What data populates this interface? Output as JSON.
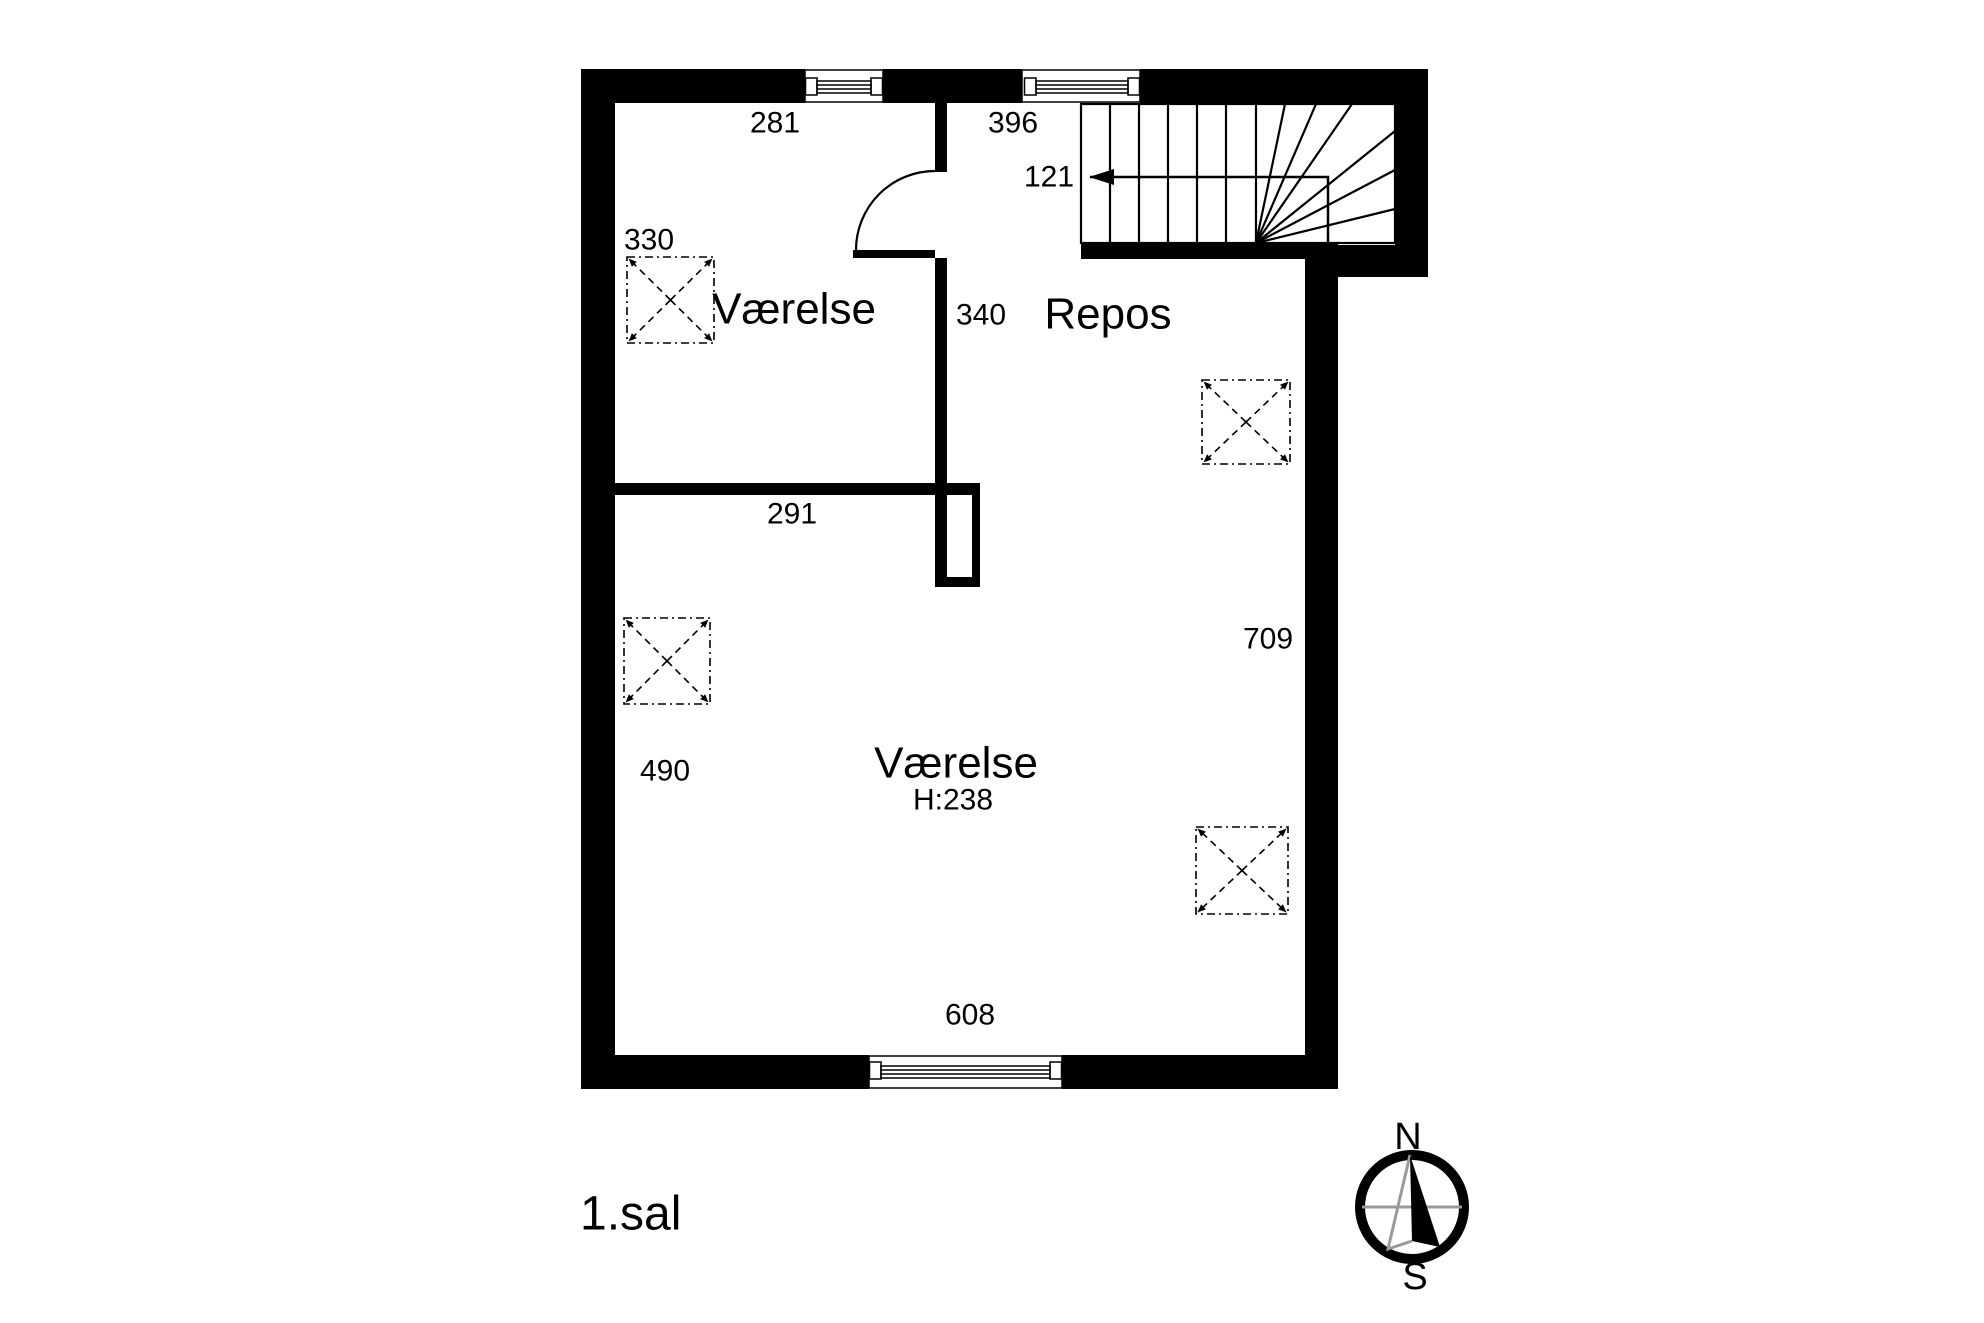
{
  "plan": {
    "floor_label": "1.sal",
    "rooms": {
      "room_top": {
        "name": "Værelse"
      },
      "landing": {
        "name": "Repos"
      },
      "room_main": {
        "name": "Værelse",
        "ceiling_height": "H:238"
      }
    },
    "dimensions": {
      "window_top_left": "281",
      "window_top_right": "396",
      "stair_run": "121",
      "room_top_skylight": "330",
      "landing_depth": "340",
      "divider_wall": "291",
      "room_main_depth": "709",
      "room_main_width": "490",
      "window_bottom": "608"
    },
    "compass": {
      "north": "N",
      "south": "S"
    }
  }
}
